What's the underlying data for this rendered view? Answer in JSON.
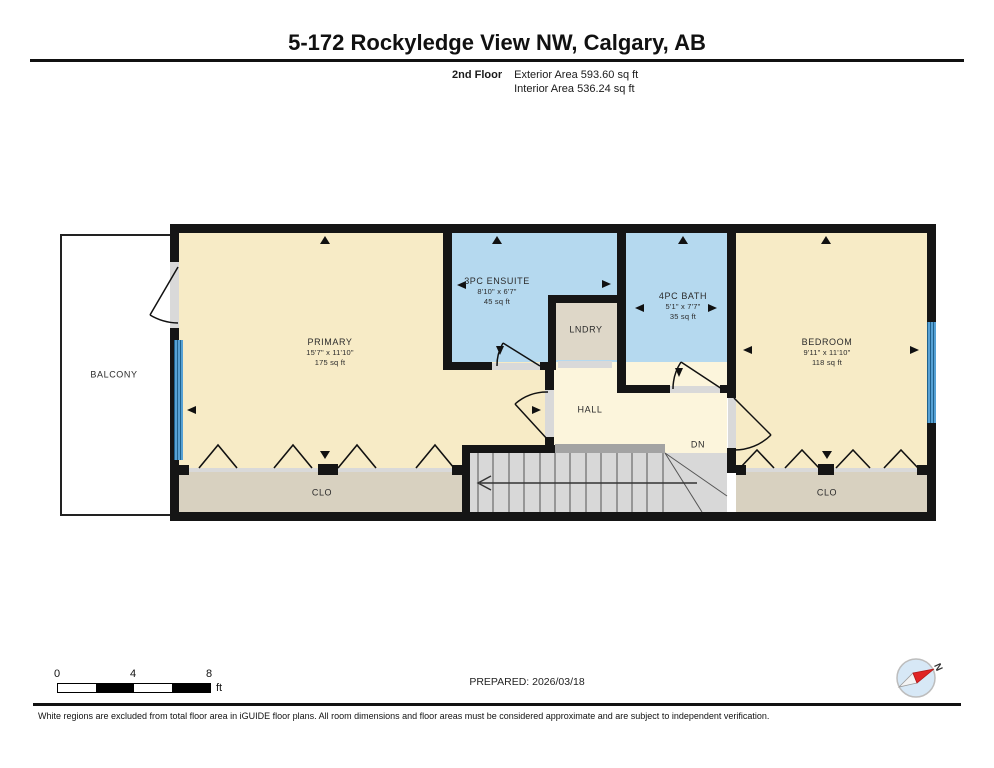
{
  "header": {
    "title": "5-172 Rockyledge View NW, Calgary, AB",
    "floor_label": "2nd Floor",
    "exterior_area": "Exterior Area 593.60 sq ft",
    "interior_area": "Interior Area 536.24 sq ft"
  },
  "rooms": {
    "primary": {
      "name": "PRIMARY",
      "dims": "15'7\" x 11'10\"",
      "area": "175 sq ft"
    },
    "ensuite": {
      "name": "3PC ENSUITE",
      "dims": "8'10\" x 6'7\"",
      "area": "45 sq ft"
    },
    "bath": {
      "name": "4PC BATH",
      "dims": "5'1\" x 7'7\"",
      "area": "35 sq ft"
    },
    "bedroom": {
      "name": "BEDROOM",
      "dims": "9'11\" x 11'10\"",
      "area": "118 sq ft"
    },
    "laundry": {
      "name": "LNDRY"
    },
    "hall": {
      "name": "HALL"
    },
    "balcony": {
      "name": "BALCONY"
    },
    "closet_primary": {
      "name": "CLO"
    },
    "closet_bedroom": {
      "name": "CLO"
    },
    "stairs_label": "DN"
  },
  "scale_bar": {
    "tick_0": "0",
    "tick_4": "4",
    "tick_8": "8",
    "unit": "ft"
  },
  "prepared_label": "PREPARED: 2026/03/18",
  "compass_label": "N",
  "disclaimer": "White regions are excluded from total floor area in iGUIDE floor plans. All room dimensions and floor areas must be considered approximate and are subject to independent verification.",
  "colors": {
    "wall": "#151515",
    "room_fill": "#f7ebc6",
    "hall_fill": "#fcf5dc",
    "wet_room_fill": "#b5d9ef",
    "closet_fill": "#d8d1c0",
    "laundry_fill": "#ded7c8",
    "stairs_fill": "#d8d8d8",
    "window_blue": "#57a1d4",
    "compass_red": "#e02424"
  }
}
